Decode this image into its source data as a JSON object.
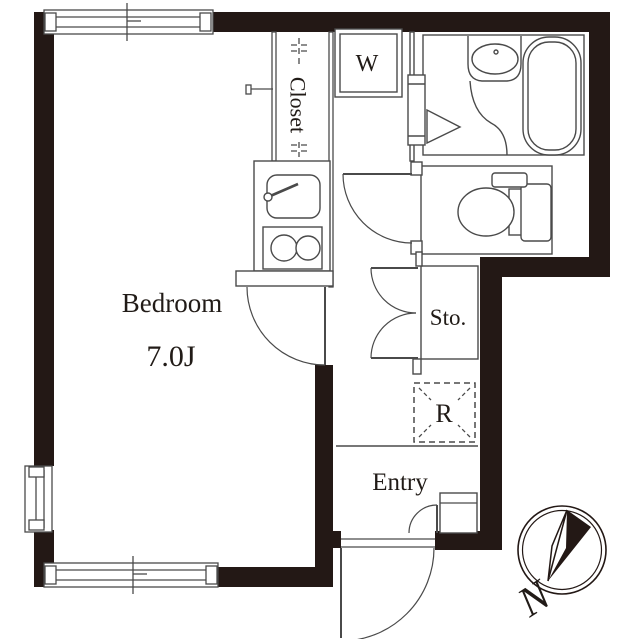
{
  "document": {
    "type": "apartment-floor-plan"
  },
  "colors": {
    "wall": "#231815",
    "line": "#4a4a4a",
    "text": "#211b17",
    "background": "#ffffff"
  },
  "rooms": {
    "bedroom": {
      "label": "Bedroom",
      "size_label": "7.0J"
    },
    "closet": {
      "label": "Closet"
    },
    "entry": {
      "label": "Entry"
    },
    "storage": {
      "label": "Sto."
    }
  },
  "appliances": {
    "washing_machine": {
      "label": "W"
    },
    "refrigerator": {
      "label": "R"
    }
  },
  "fixtures": [
    "kitchen-sink",
    "two-burner-stove",
    "bathroom-vanity-sink",
    "bathtub",
    "toilet",
    "sliding-bath-door-triangle",
    "closet-hanger-pole"
  ],
  "compass": {
    "north_label": "N"
  }
}
